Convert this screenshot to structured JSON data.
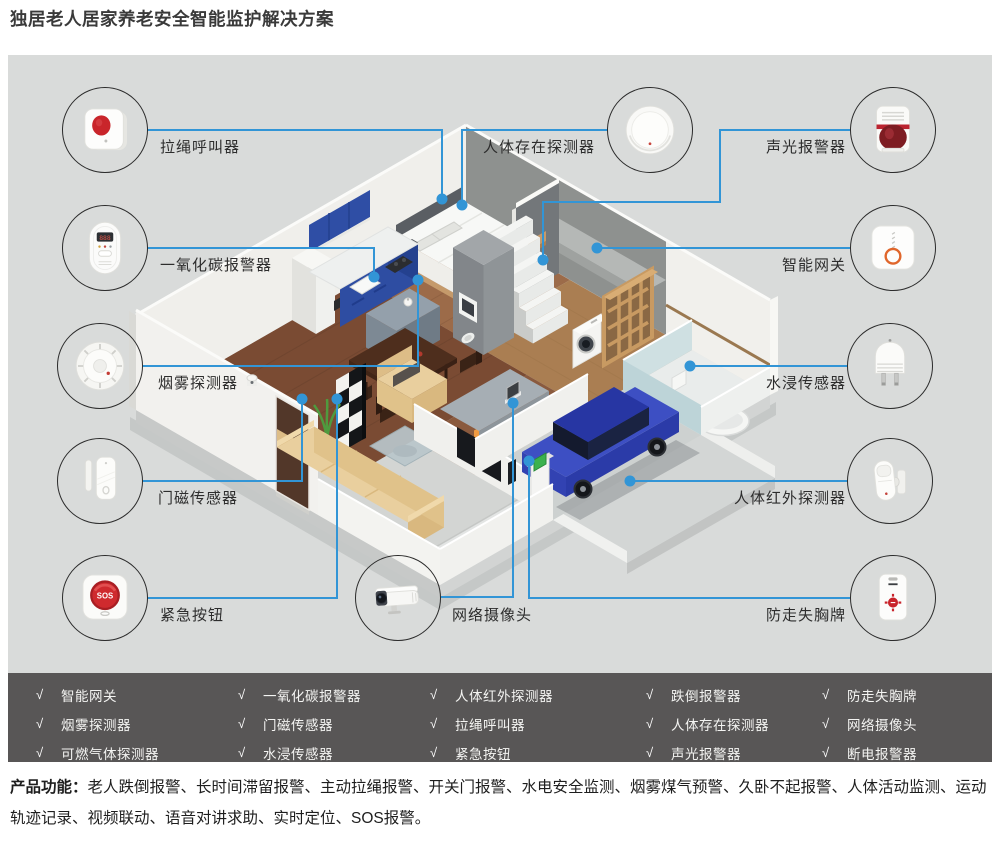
{
  "title": "独居老人居家养老安全智能监护解决方案",
  "colors": {
    "accent_blue": "#3295d6",
    "panel_bg": "#d9dbda",
    "checklist_bg": "#585656",
    "text_dark": "#2d2d2d"
  },
  "devices": {
    "items": [
      {
        "id": "pull-cord-caller",
        "label": "拉绳呼叫器",
        "icon": "pull-cord-caller-icon"
      },
      {
        "id": "co-alarm",
        "label": "一氧化碳报警器",
        "icon": "co-alarm-icon"
      },
      {
        "id": "smoke-detector",
        "label": "烟雾探测器",
        "icon": "smoke-detector-icon"
      },
      {
        "id": "door-magnet-sensor",
        "label": "门磁传感器",
        "icon": "door-sensor-icon"
      },
      {
        "id": "emergency-button",
        "label": "紧急按钮",
        "icon": "emergency-button-icon"
      },
      {
        "id": "presence-detector",
        "label": "人体存在探测器",
        "icon": "presence-detector-icon"
      },
      {
        "id": "sound-light-alarm",
        "label": "声光报警器",
        "icon": "sound-light-alarm-icon"
      },
      {
        "id": "smart-gateway",
        "label": "智能网关",
        "icon": "smart-gateway-icon"
      },
      {
        "id": "water-leak-sensor",
        "label": "水浸传感器",
        "icon": "water-sensor-icon"
      },
      {
        "id": "pir-detector",
        "label": "人体红外探测器",
        "icon": "pir-detector-icon"
      },
      {
        "id": "anti-lost-badge",
        "label": "防走失胸牌",
        "icon": "anti-lost-badge-icon"
      },
      {
        "id": "network-camera",
        "label": "网络摄像头",
        "icon": "network-camera-icon"
      }
    ]
  },
  "checklist": {
    "check_glyph": "√",
    "columns": [
      [
        "智能网关",
        "烟雾探测器",
        "可燃气体探测器"
      ],
      [
        "一氧化碳报警器",
        "门磁传感器",
        "水浸传感器"
      ],
      [
        "人体红外探测器",
        "拉绳呼叫器",
        "紧急按钮"
      ],
      [
        "跌倒报警器",
        "人体存在探测器",
        "声光报警器"
      ],
      [
        "防走失胸牌",
        "网络摄像头",
        "断电报警器"
      ]
    ]
  },
  "footer": {
    "label": "产品功能：",
    "text": "老人跌倒报警、长时间滞留报警、主动拉绳报警、开关门报警、水电安全监测、烟雾煤气预警、久卧不起报警、人体活动监测、运动轨迹记录、视频联动、语音对讲求助、实时定位、SOS报警。"
  }
}
